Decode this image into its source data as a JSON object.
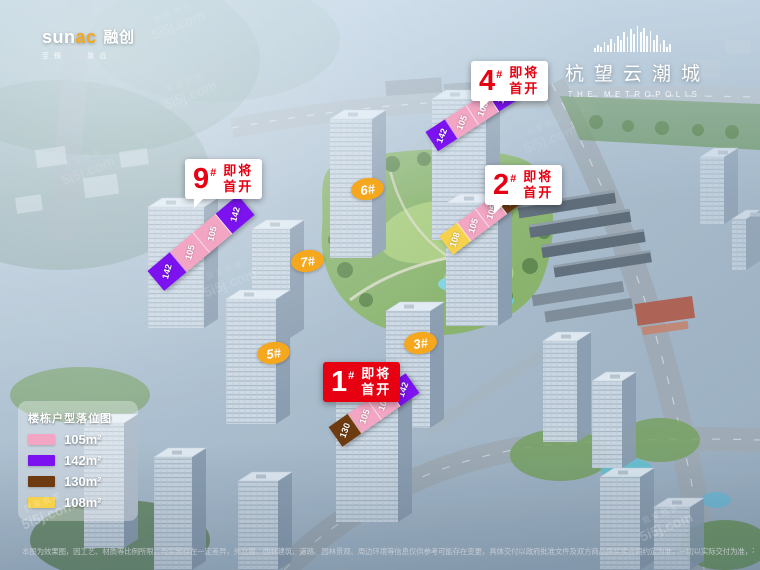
{
  "brand": {
    "latin_a": "sun",
    "latin_b": "ac",
    "cn": "融创",
    "tagline": "至臻 · 致远"
  },
  "project": {
    "name": "杭望云潮城",
    "name_en": "THE METROPOLIS"
  },
  "callouts": {
    "c9": {
      "number": "9",
      "hash": "#",
      "line1": "即将",
      "line2": "首开"
    },
    "c4": {
      "number": "4",
      "hash": "#",
      "line1": "即将",
      "line2": "首开"
    },
    "c2": {
      "number": "2",
      "hash": "#",
      "line1": "即将",
      "line2": "首开"
    },
    "c1": {
      "number": "1",
      "hash": "#",
      "line1": "即将",
      "line2": "首开"
    }
  },
  "badges": {
    "b6": "6#",
    "b7": "7#",
    "b5": "5#",
    "b3": "3#"
  },
  "roofs": {
    "r9": {
      "segments": [
        {
          "area": "142",
          "color": "#7b12ef"
        },
        {
          "area": "105",
          "color": "#f2a6c3"
        },
        {
          "area": "105",
          "color": "#f2a6c3"
        },
        {
          "area": "142",
          "color": "#7b12ef"
        }
      ]
    },
    "r4": {
      "segments": [
        {
          "area": "142",
          "color": "#7b12ef"
        },
        {
          "area": "105",
          "color": "#f2a6c3"
        },
        {
          "area": "105",
          "color": "#f2a6c3"
        },
        {
          "area": "142",
          "color": "#7b12ef"
        }
      ]
    },
    "r2": {
      "segments": [
        {
          "area": "108",
          "color": "#f6d24c"
        },
        {
          "area": "105",
          "color": "#f2a6c3"
        },
        {
          "area": "105",
          "color": "#f2a6c3"
        },
        {
          "area": "130",
          "color": "#6e3b10"
        }
      ]
    },
    "r1": {
      "segments": [
        {
          "area": "130",
          "color": "#6e3b10"
        },
        {
          "area": "105",
          "color": "#f2a6c3"
        },
        {
          "area": "105",
          "color": "#f2a6c3"
        },
        {
          "area": "142",
          "color": "#7b12ef"
        }
      ]
    }
  },
  "legend": {
    "title": "楼栋户型落位图",
    "items": [
      {
        "label": "105m²",
        "color": "#f2a6c3"
      },
      {
        "label": "142m²",
        "color": "#7b12ef"
      },
      {
        "label": "130m²",
        "color": "#6e3b10"
      },
      {
        "label": "108m²",
        "color": "#f6d24c"
      }
    ]
  },
  "watermark": {
    "cn": "我爱我家",
    "latin": "5i5j.com"
  },
  "accent_red": "#e60012",
  "badge_orange": "#f5a71e",
  "disclaimer": "本图为效果图，因工艺、材质等比例所限，与实景存在一定差异，外立面、园林建筑、道路、园林景观、周边环境等信息仅供参考可能存在变更，具体交付以政府批准文件及双方商品房买卖合同约定为准，一切以实际交付为准，不再另行通知，本图中楼栋样式仅供参考，来源于相关交付标准数据。"
}
